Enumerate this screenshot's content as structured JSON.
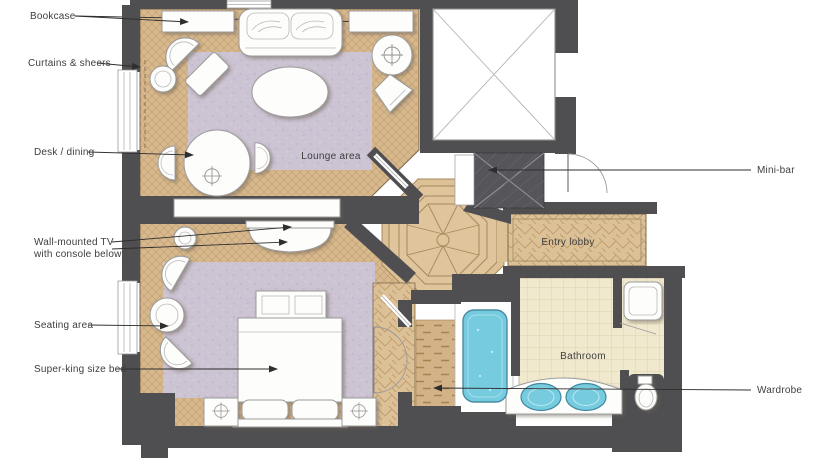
{
  "title": "Hotel suite floor plan",
  "rooms": {
    "lounge": "Lounge area",
    "entry_lobby": "Entry lobby",
    "bathroom": "Bathroom"
  },
  "callouts": {
    "left": [
      {
        "id": "bookcase",
        "text": "Bookcase"
      },
      {
        "id": "curtains",
        "text": "Curtains & sheers"
      },
      {
        "id": "desk_dining",
        "text": "Desk / dining"
      },
      {
        "id": "wall_tv",
        "text": "Wall-mounted TV",
        "text2": "with console below"
      },
      {
        "id": "seating_area",
        "text": "Seating area"
      },
      {
        "id": "super_king_bed",
        "text": "Super-king size bed"
      }
    ],
    "right": [
      {
        "id": "minibar",
        "text": "Mini-bar"
      },
      {
        "id": "wardrobe",
        "text": "Wardrobe"
      }
    ]
  },
  "colors": {
    "wall": "#4f4f52",
    "parquet": "#d8b98e",
    "parquet_line": "#c2a074",
    "carpet": "#ccc3d3",
    "tile": "#f0e9ce",
    "tile_line": "#d9cda8",
    "water_blue": "#76cbdf",
    "furniture_white": "#fdfdfb",
    "label_text": "#3e3e3e"
  },
  "fixtures": [
    "sofa",
    "bookcases",
    "armchairs",
    "ottoman",
    "coffee-table",
    "dining-table",
    "round-table",
    "tv-console",
    "bench",
    "bed",
    "nightstands",
    "bathtub",
    "double-basin-vanity",
    "toilet",
    "shower",
    "wardrobe-shelving",
    "mini-bar",
    "entry-door",
    "service-shaft"
  ]
}
